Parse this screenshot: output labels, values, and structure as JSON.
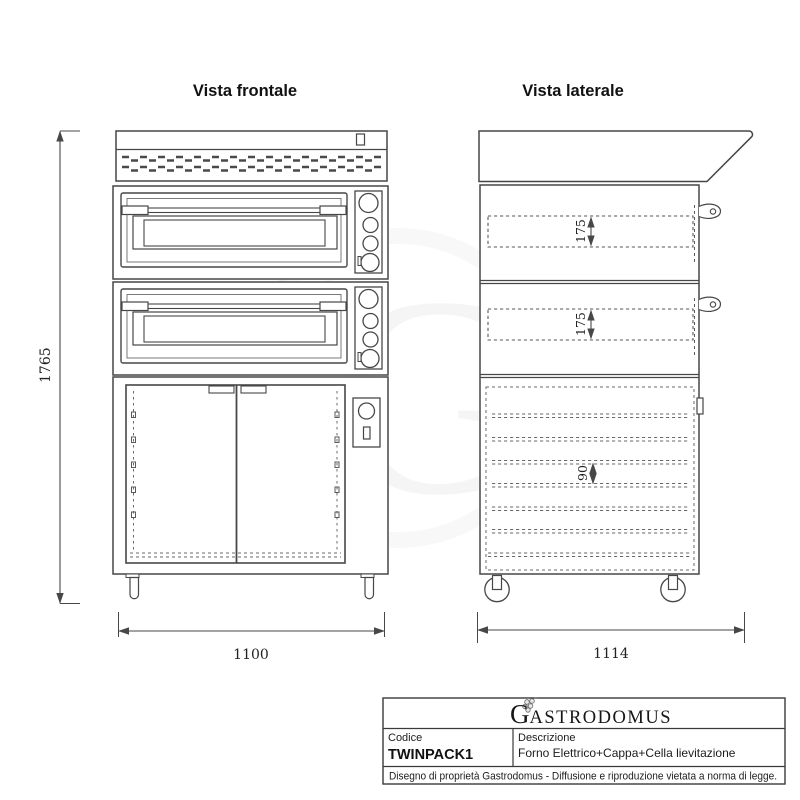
{
  "views": {
    "front": {
      "title": "Vista frontale"
    },
    "side": {
      "title": "Vista laterale"
    }
  },
  "dimensions": {
    "overall_height": "1765",
    "front_width": "1100",
    "side_depth": "1114",
    "chamber_top": "175",
    "chamber_bottom": "175",
    "shelf_spacing": "90"
  },
  "title_block": {
    "logo_initial": "G",
    "logo_rest": "ASTRODOMUS",
    "code_label": "Codice",
    "code_value": "TWINPACK1",
    "description_label": "Descrizione",
    "description_value": "Forno Elettrico+Cappa+Cella lievitazione",
    "disclaimer": "Disegno di proprietà Gastrodomus - Diffusione e riproduzione vietata a norma di legge."
  },
  "colors": {
    "line": "#474747",
    "text": "#1c1c1c",
    "watermark": "rgba(0,0,0,0.045)"
  }
}
